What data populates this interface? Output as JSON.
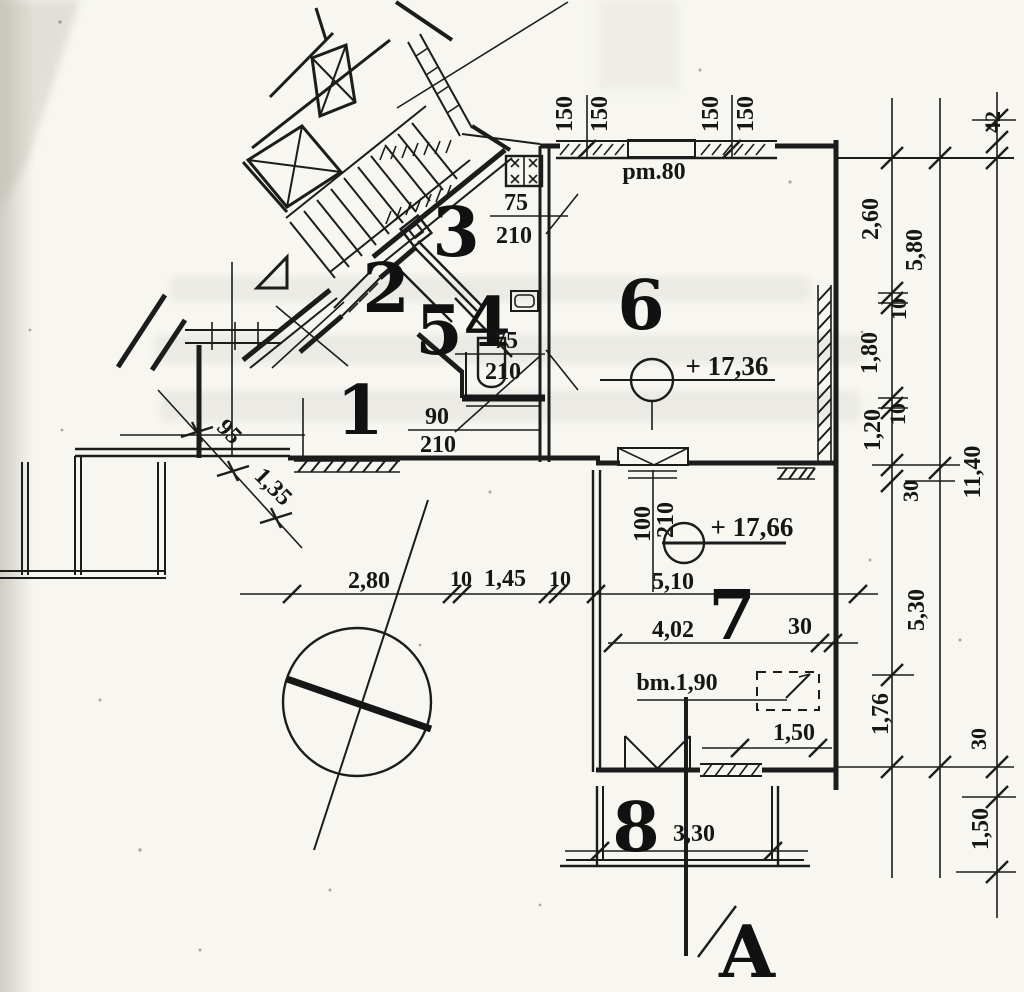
{
  "drawing": {
    "room_numbers": [
      "1",
      "2",
      "3",
      "4",
      "5",
      "6",
      "7",
      "8"
    ],
    "section_marker": "A",
    "floor_levels": [
      "+ 17,36",
      "+ 17,66"
    ],
    "window_marks": {
      "top_parapet": "pm.80",
      "balcony_parapet": "bm.1,90",
      "top_window_widths": [
        "150",
        "150",
        "150",
        "150"
      ]
    },
    "door_sizes": [
      {
        "width": "75",
        "height": "210"
      },
      {
        "width": "75",
        "height": "210"
      },
      {
        "width": "90",
        "height": "210"
      },
      {
        "width": "100",
        "height": "210"
      }
    ],
    "dimensions": {
      "interior_chain": [
        "2,80",
        "10",
        "1,45",
        "10",
        "5,10"
      ],
      "room7_chain": [
        "4,02",
        "30"
      ],
      "balcony_chain": [
        "3,30",
        "1,50"
      ],
      "right_chain_inner": [
        "2,60",
        "10",
        "1,80",
        "10",
        "1,20",
        "30",
        "1,76"
      ],
      "right_chain_middle": [
        "5,80",
        "5,30"
      ],
      "right_chain_outer": [
        "42",
        "11,40",
        "30",
        "1,50"
      ],
      "left_diagonal_chain": [
        "95",
        "1,35"
      ]
    }
  }
}
